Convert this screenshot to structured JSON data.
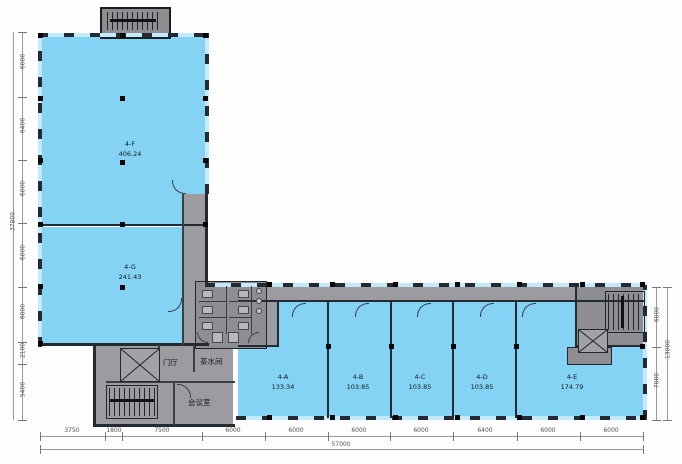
{
  "plan": {
    "rooms": [
      {
        "id": "4-F",
        "area": "406.24"
      },
      {
        "id": "4-G",
        "area": "241.43"
      },
      {
        "id": "4-A",
        "area": "133.34"
      },
      {
        "id": "4-B",
        "area": "103.85"
      },
      {
        "id": "4-C",
        "area": "103.85"
      },
      {
        "id": "4-D",
        "area": "103.85"
      },
      {
        "id": "4-E",
        "area": "174.79"
      }
    ],
    "spaces": {
      "lobby": "门厅",
      "pantry": "茶水间",
      "meeting": "会议室"
    },
    "dimensions": {
      "left": {
        "segments": [
          "6000",
          "6400",
          "6000",
          "6000",
          "6000",
          "2100",
          "5400"
        ],
        "total": "37800"
      },
      "bottom": {
        "segments": [
          "3750",
          "1800",
          "7500",
          "6000",
          "6000",
          "6000",
          "6000",
          "6400",
          "6000",
          "6000"
        ],
        "total": "57000"
      },
      "right": {
        "segments": [
          "6000",
          "7000"
        ],
        "total": "13000"
      }
    },
    "colors": {
      "room_fill": "#84d3f5",
      "window": "#c2eafb",
      "wall": "#232a31",
      "corridor": "#9c9ca0",
      "service": "#8e8e92"
    }
  }
}
